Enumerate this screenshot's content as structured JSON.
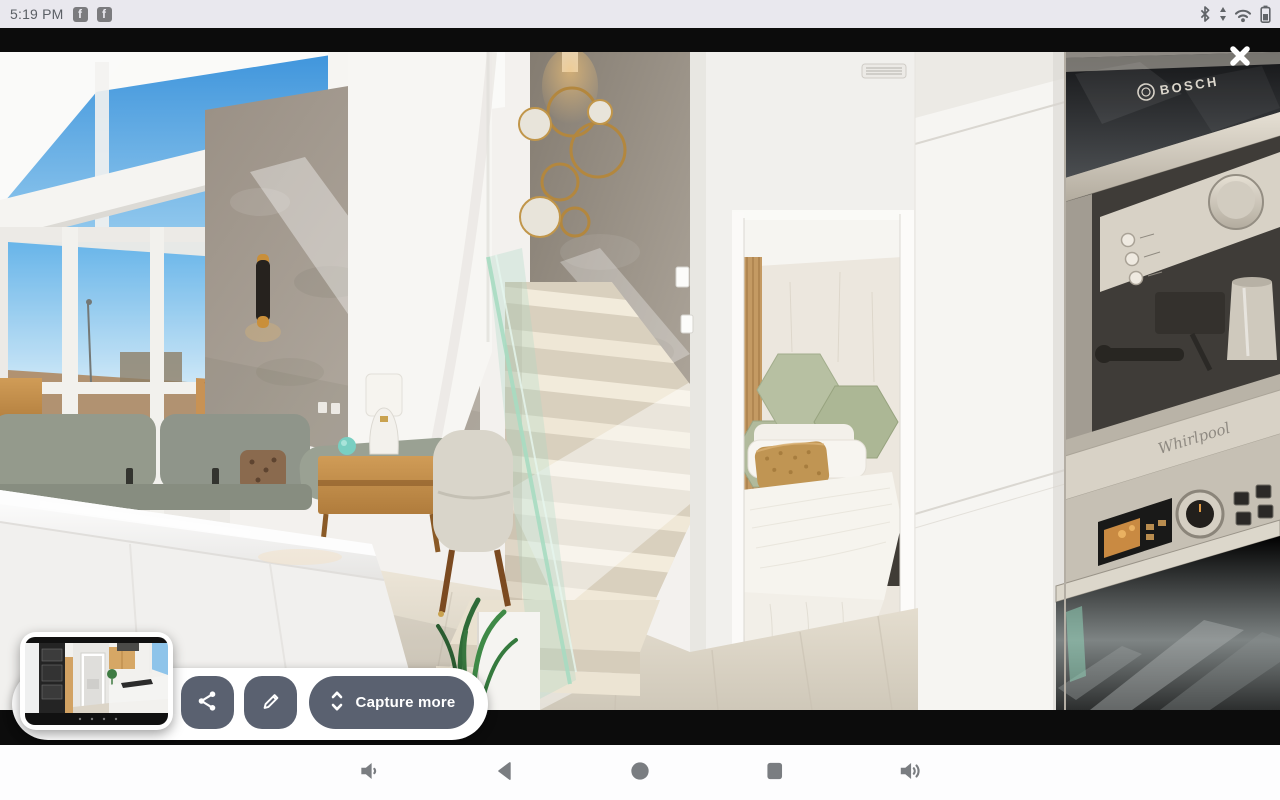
{
  "status_bar": {
    "time": "5:19 PM",
    "notifications": [
      {
        "icon": "facebook-icon",
        "glyph": "f"
      },
      {
        "icon": "facebook-icon",
        "glyph": "f"
      }
    ],
    "system_icons": [
      "bluetooth-icon",
      "network-activity-icon",
      "wifi-icon",
      "battery-icon"
    ]
  },
  "screenshot_preview": {
    "image_alt": "Modern duplex interior: living room with windows and sofa, beige staircase with glass balustrade, bedroom doorway, built-in kitchen appliances",
    "close_icon": "close-x",
    "brands": {
      "microwave": "BOSCH",
      "oven": "Whirlpool"
    }
  },
  "toolbar": {
    "buttons": [
      {
        "name": "share",
        "icon": "share-icon",
        "label": ""
      },
      {
        "name": "edit",
        "icon": "pencil-icon",
        "label": ""
      },
      {
        "name": "capture-more",
        "icon": "expand-vertical-icon",
        "label": "Capture more"
      }
    ]
  },
  "nav_bar": {
    "buttons": [
      {
        "name": "volume-down",
        "icon": "volume-down-icon"
      },
      {
        "name": "back",
        "icon": "back-icon"
      },
      {
        "name": "home",
        "icon": "home-icon"
      },
      {
        "name": "recents",
        "icon": "recents-icon"
      },
      {
        "name": "volume-up",
        "icon": "volume-up-icon"
      }
    ]
  },
  "colors": {
    "action_button_bg": "#5a6170",
    "panel_bg": "#ffffff",
    "status_bar_bg": "#e9e8ee",
    "nav_bar_bg": "#fdfdfe",
    "nav_icon": "#7a7d81",
    "letterbox": "#0c0c0c"
  }
}
